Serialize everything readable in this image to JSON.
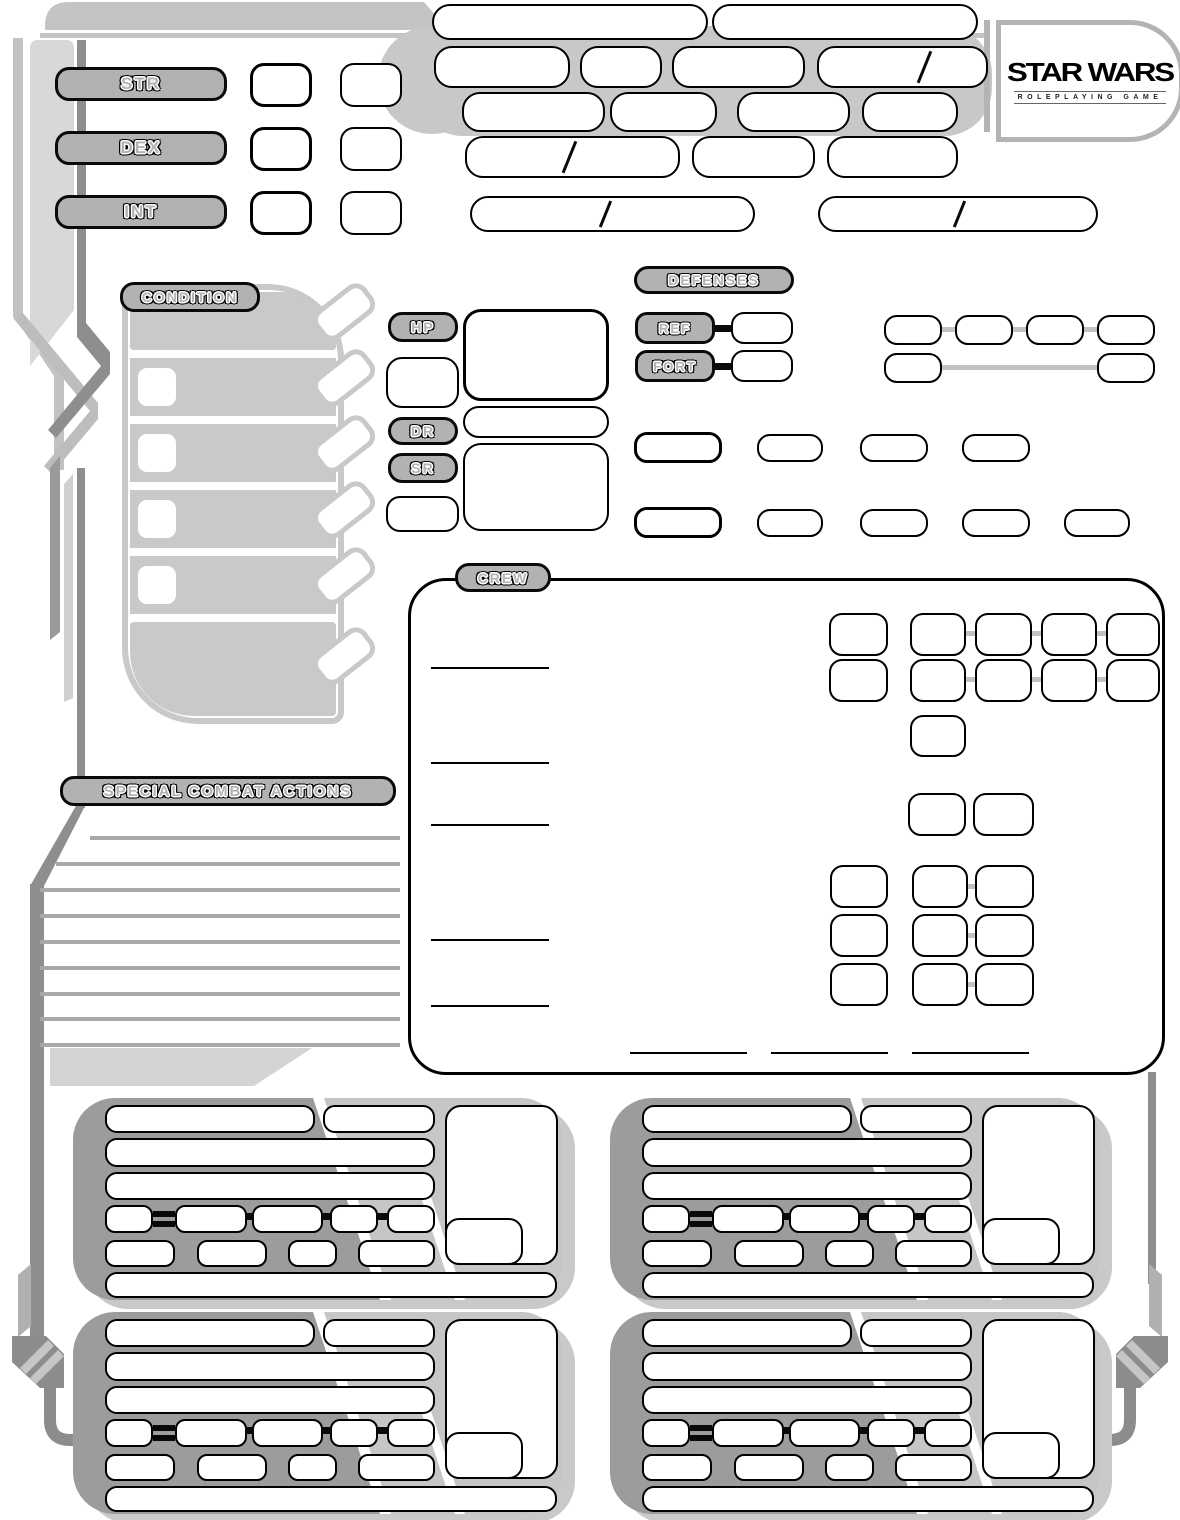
{
  "brand": {
    "title": "STAR WARS",
    "subtitle": "ROLEPLAYING GAME"
  },
  "abilities": {
    "items": [
      {
        "label": "STR"
      },
      {
        "label": "DEX"
      },
      {
        "label": "INT"
      }
    ]
  },
  "condition": {
    "label": "CONDITION",
    "steps": 6
  },
  "vitals": {
    "hp_label": "HP",
    "dr_label": "DR",
    "sr_label": "SR"
  },
  "defenses": {
    "label": "DEFENSES",
    "ref_label": "REF",
    "fort_label": "FORT"
  },
  "crew": {
    "label": "CREW"
  },
  "special_combat_actions": {
    "label": "SPECIAL COMBAT ACTIONS"
  }
}
